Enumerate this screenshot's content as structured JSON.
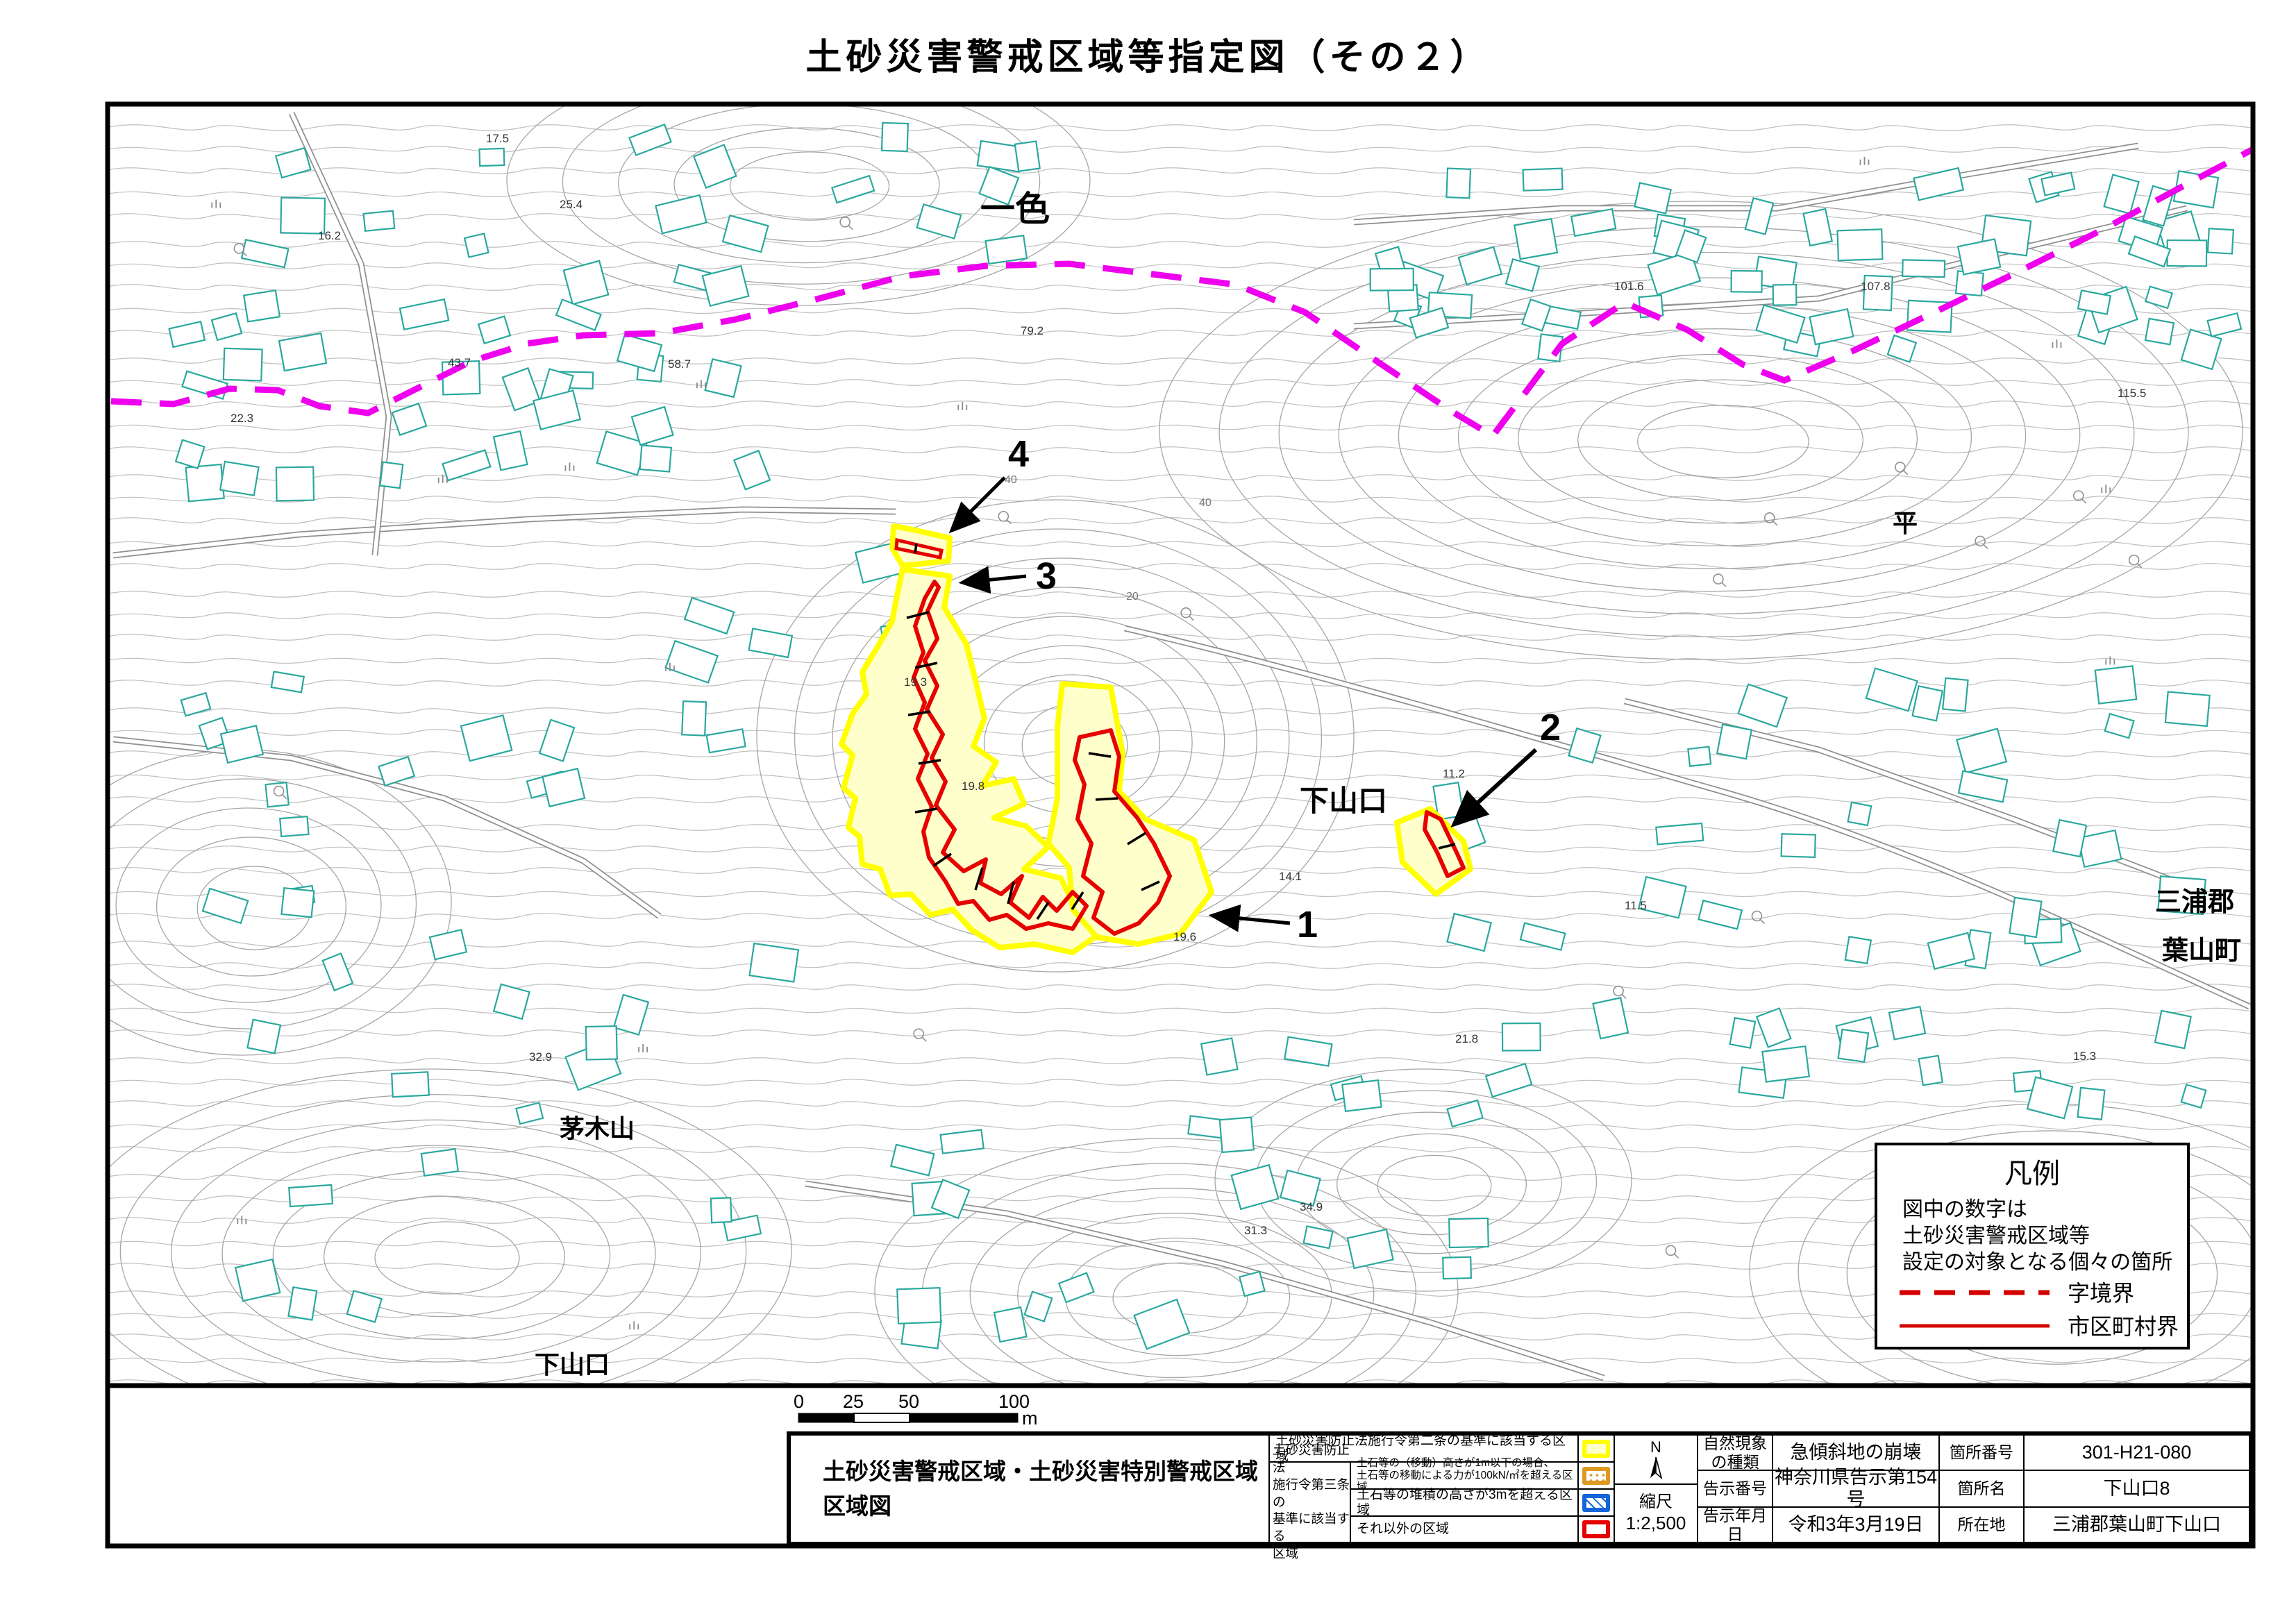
{
  "page_title": "土砂災害警戒区域等指定図（その２）",
  "colors": {
    "warning_yellow": "#ffff00",
    "warning_fill": "#ffffcc",
    "special_red": "#e60000",
    "boundary_magenta": "#ee00ee",
    "building_teal": "#2aa89e",
    "contour_gray": "#b0b0b0",
    "legend_red": "#d40000"
  },
  "map": {
    "place_labels": [
      {
        "text": "一色"
      },
      {
        "text": "平"
      },
      {
        "text": "下山口"
      },
      {
        "text": "三浦郡"
      },
      {
        "text": "葉山町"
      },
      {
        "text": "茅木山"
      },
      {
        "text": "下山口"
      }
    ],
    "zone_numbers": [
      {
        "num": "1"
      },
      {
        "num": "2"
      },
      {
        "num": "3"
      },
      {
        "num": "4"
      }
    ],
    "spot_elevations": [
      {
        "value": "17.5"
      },
      {
        "value": "25.4"
      },
      {
        "value": "16.2"
      },
      {
        "value": "22.3"
      },
      {
        "value": "43.7"
      },
      {
        "value": "58.7"
      },
      {
        "value": "79.2"
      },
      {
        "value": "101.6"
      },
      {
        "value": "107.8"
      },
      {
        "value": "115.5"
      },
      {
        "value": "19.3"
      },
      {
        "value": "19.8"
      },
      {
        "value": "19.6"
      },
      {
        "value": "14.1"
      },
      {
        "value": "11.2"
      },
      {
        "value": "11.5"
      },
      {
        "value": "32.9"
      },
      {
        "value": "21.8"
      },
      {
        "value": "15.3"
      },
      {
        "value": "31.3"
      },
      {
        "value": "34.9"
      }
    ],
    "contour_labels": [
      {
        "value": "40"
      },
      {
        "value": "40"
      },
      {
        "value": "20"
      }
    ]
  },
  "legend": {
    "title": "凡例",
    "note_lines": [
      "図中の数字は",
      "土砂災害警戒区域等",
      "設定の対象となる個々の箇所"
    ],
    "items": [
      {
        "label": "字境界"
      },
      {
        "label": "市区町村界"
      }
    ]
  },
  "scalebar": {
    "ticks": [
      "0",
      "25",
      "50",
      "100"
    ],
    "unit": "m"
  },
  "footer": {
    "sheet_title_line1": "土砂災害警戒区域・土砂災害特別警戒区域",
    "sheet_title_line2": "区域図",
    "zone2_row_label": "土砂災害防止法施行令第二条の基準に該当する区域",
    "zone3_header_lines": [
      "土砂災害防止法",
      "施行令第三条の",
      "基準に該当する",
      "区域"
    ],
    "zone3_rows": [
      {
        "line1": "土石等の（移動）高さが1m以下の場合、",
        "line2": "土石等の移動による力が100kN/㎡を超える区域"
      },
      {
        "line1": "土石等の堆積の高さが3mを超える区域",
        "line2": ""
      },
      {
        "line1": "それ以外の区域",
        "line2": ""
      }
    ],
    "compass_n": "N",
    "scale_label": "縮尺",
    "scale_value": "1:2,500",
    "info_rows": [
      {
        "label": "自然現象の種類",
        "value": "急傾斜地の崩壊",
        "label2": "箇所番号",
        "value2": "301-H21-080"
      },
      {
        "label": "告示番号",
        "value": "神奈川県告示第154号",
        "label2": "箇所名",
        "value2": "下山口8"
      },
      {
        "label": "告示年月日",
        "value": "令和3年3月19日",
        "label2": "所在地",
        "value2": "三浦郡葉山町下山口"
      }
    ]
  }
}
